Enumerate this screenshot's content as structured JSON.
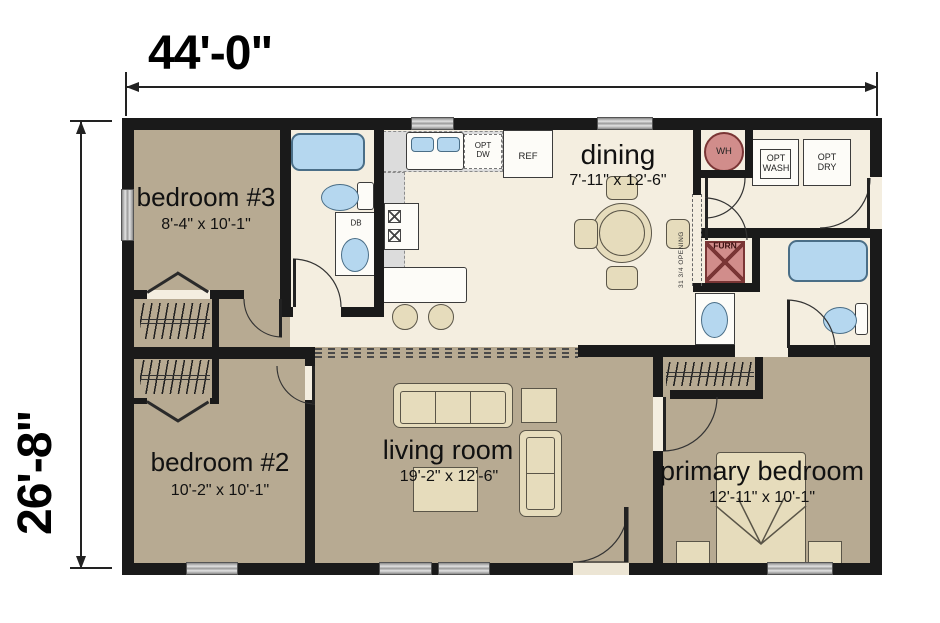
{
  "plan": {
    "width_label": "44'-0\"",
    "height_label": "26'-8\"",
    "rooms": {
      "bedroom3": {
        "name": "bedroom #3",
        "size": "8'-4\" x 10'-1\""
      },
      "dining": {
        "name": "dining",
        "size": "7'-11\" x 12'-6\""
      },
      "bedroom2": {
        "name": "bedroom #2",
        "size": "10'-2\" x 10'-1\""
      },
      "living": {
        "name": "living room",
        "size": "19'-2\" x 12'-6\""
      },
      "primary": {
        "name": "primary bedroom",
        "size": "12'-11\" x 10'-1\""
      }
    },
    "fixtures": {
      "sink_cabinet": "DB",
      "refrigerator": "REF",
      "opt_dishwasher": "OPT\nDW",
      "water_heater": "WH",
      "opt_washer": "OPT\nWASH",
      "opt_dryer": "OPT\nDRY",
      "furnace": "FURN",
      "opening_note": "31 3/4 OPENING"
    },
    "colors": {
      "wall": "#1a1a1a",
      "floor_tan": "#b7aa92",
      "floor_cream": "#f4eee0",
      "fixture_blue": "#b5d7ef",
      "utility_pink": "#d18d8b",
      "furniture_beige": "#e6dcbc",
      "counter_gray": "#dcdcdc",
      "window_gray": "#c4c4c4"
    }
  }
}
